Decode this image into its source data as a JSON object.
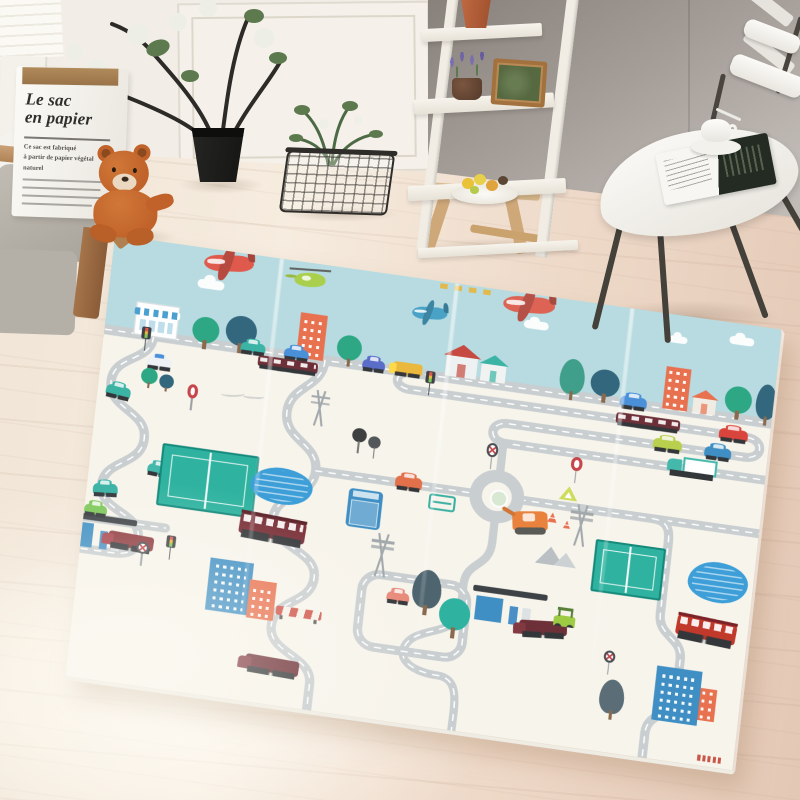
{
  "poster": {
    "title_line1": "Le sac",
    "title_line2": "en papier",
    "body_lines": [
      "Ce sac est fabriqué",
      "à partir de papier végétal",
      "naturel"
    ]
  },
  "colors": {
    "wall_left": "#f2eee7",
    "wall_right": "#9b948e",
    "sofa": "#c2bdb4",
    "wood": "#a5744a",
    "teddy": "#c0622a",
    "plant_pot": "#141412",
    "basket": "#2f2d2a",
    "shelf": "#f1ede4",
    "chair": "#f6f4ef",
    "floor": "#f0e2d2"
  },
  "mat": {
    "sky_color": "#b7dbe0",
    "ground_color": "#f7f4ec",
    "road_color": "#c9ced0",
    "road_dash_color": "#ffffff",
    "crease_positions": [
      160,
      330,
      500
    ],
    "roads": [
      {
        "d": "M -12 95 H 662",
        "w": 10
      },
      {
        "d": "M 300 95 C 282 95 282 112 300 112 H 628 C 646 112 646 132 628 132 H 398 C 379 132 379 152 398 152 H 662",
        "w": 9
      },
      {
        "d": "M 48 95 C 48 122 12 118 12 146 C 12 174 50 170 50 198 C 50 226 14 224 14 250 C 14 276 55 272 55 298 C 55 314 42 316 30 316 H -12",
        "w": 9
      },
      {
        "d": "M 215 95 C 215 124 184 124 184 152 C 184 180 218 178 218 206 C 218 234 182 232 182 260 C 182 288 228 284 228 312 C 228 340 192 338 192 366 C 192 394 235 390 235 418 V 450",
        "w": 9
      },
      {
        "d": "M 218 206 H 374",
        "w": 9
      },
      {
        "d": "M 395 152 V 183",
        "w": 8,
        "nd": true
      },
      {
        "d": "M 416 206 H 662",
        "w": 9
      },
      {
        "d": "M 395 227 V 252 C 395 278 372 274 372 298 V 322",
        "w": 8,
        "nd": true
      },
      {
        "d": "M 372 322 C 372 352 330 345 322 368 C 316 386 340 392 356 392 C 380 392 376 418 376 450",
        "w": 8
      },
      {
        "d": "M 546 206 C 564 206 564 218 564 232 V 300 C 564 322 588 320 588 342 V 378 C 588 400 562 398 562 420 V 450",
        "w": 9
      },
      {
        "d": "M 292 300 H 360 A 17 17 0 0 1 377 317 V 356 A 17 17 0 0 1 360 373 H 292 A 17 17 0 0 1 275 356 V 317 A 17 17 0 0 1 292 300 Z",
        "w": 9
      },
      {
        "d": "M -12 284 H 80",
        "w": 9
      },
      {
        "d": "M 415 206 A 20.5 20.5 0 1 1 374 206 A 20.5 20.5 0 1 1 415 206",
        "w": 12,
        "nd": true
      }
    ],
    "items": [
      {
        "t": "plane",
        "x": 88,
        "y": 4,
        "w": 48,
        "h": 16,
        "c": "#df5a4c",
        "r": -6
      },
      {
        "t": "plane",
        "x": 378,
        "y": 3,
        "w": 50,
        "h": 16,
        "c": "#dd6355",
        "r": -4
      },
      {
        "t": "heli",
        "x": 176,
        "y": 10,
        "w": 30,
        "h": 14,
        "c": "#a9cf4d",
        "r": -4
      },
      {
        "t": "plane",
        "x": 292,
        "y": 27,
        "w": 34,
        "h": 12,
        "c": "#4aa3c7",
        "r": -5
      },
      {
        "t": "cloud",
        "x": 84,
        "y": 31,
        "w": 26,
        "h": 9,
        "c": "#ffffff"
      },
      {
        "t": "cloud",
        "x": 400,
        "y": 26,
        "w": 24,
        "h": 8,
        "c": "#ffffff"
      },
      {
        "t": "cloud",
        "x": 598,
        "y": 13,
        "w": 24,
        "h": 8,
        "c": "#ffffff"
      },
      {
        "t": "cloud",
        "x": 540,
        "y": 21,
        "w": 18,
        "h": 7,
        "c": "#ffffff"
      },
      {
        "t": "dashes",
        "x": 316,
        "y": 2,
        "w": 54,
        "h": 5,
        "c": "#e7b53c"
      },
      {
        "t": "shop",
        "x": 28,
        "y": 62,
        "w": 42,
        "h": 33,
        "c": "#ffffff",
        "c2": "#4aa0d0"
      },
      {
        "t": "tree",
        "x": 84,
        "y": 68,
        "w": 26,
        "h": 26,
        "c": "#2ea884"
      },
      {
        "t": "tree",
        "x": 116,
        "y": 62,
        "w": 30,
        "h": 30,
        "c": "#33677e"
      },
      {
        "t": "tlight",
        "x": 36,
        "y": 86,
        "w": 9,
        "h": 24
      },
      {
        "t": "bldg",
        "x": 186,
        "y": 50,
        "w": 26,
        "h": 45,
        "c": "#e8714f"
      },
      {
        "t": "car",
        "x": 132,
        "y": 87,
        "w": 24,
        "h": 10,
        "c": "#3bb3a5"
      },
      {
        "t": "car",
        "x": 174,
        "y": 87,
        "w": 24,
        "h": 10,
        "c": "#4a90d9"
      },
      {
        "t": "tree",
        "x": 224,
        "y": 66,
        "w": 24,
        "h": 25,
        "c": "#2ea884"
      },
      {
        "t": "train",
        "x": 150,
        "y": 98,
        "w": 58,
        "h": 11,
        "c": "#6e3038"
      },
      {
        "t": "car",
        "x": 250,
        "y": 87,
        "w": 22,
        "h": 10,
        "c": "#5a6ec9"
      },
      {
        "t": "truck",
        "x": 280,
        "y": 85,
        "w": 28,
        "h": 12,
        "c": "#e9b83c"
      },
      {
        "t": "tlight",
        "x": 312,
        "y": 90,
        "w": 9,
        "h": 24
      },
      {
        "t": "house",
        "x": 330,
        "y": 70,
        "w": 30,
        "h": 22,
        "c": "#eef1f1",
        "c2": "#c64a42"
      },
      {
        "t": "house",
        "x": 364,
        "y": 74,
        "w": 24,
        "h": 18,
        "c": "#f0f3f2",
        "c2": "#3bb3a5"
      },
      {
        "t": "poplar",
        "x": 440,
        "y": 58,
        "w": 24,
        "h": 35,
        "c": "#3f9f8a"
      },
      {
        "t": "tree",
        "x": 470,
        "y": 64,
        "w": 28,
        "h": 27,
        "c": "#33677e"
      },
      {
        "t": "car",
        "x": 500,
        "y": 87,
        "w": 26,
        "h": 11,
        "c": "#4a90d9"
      },
      {
        "t": "bldg",
        "x": 541,
        "y": 52,
        "w": 24,
        "h": 42,
        "c": "#e8714f"
      },
      {
        "t": "house",
        "x": 570,
        "y": 78,
        "w": 22,
        "h": 16,
        "c": "#f0ece4",
        "c2": "#e8714f"
      },
      {
        "t": "tree",
        "x": 600,
        "y": 62,
        "w": 26,
        "h": 27,
        "c": "#2ea884"
      },
      {
        "t": "poplar",
        "x": 630,
        "y": 56,
        "w": 20,
        "h": 35,
        "c": "#33677e"
      },
      {
        "t": "train",
        "x": 498,
        "y": 104,
        "w": 62,
        "h": 11,
        "c": "#6e3038"
      },
      {
        "t": "car",
        "x": 598,
        "y": 105,
        "w": 28,
        "h": 11,
        "c": "#d9453c"
      },
      {
        "t": "car",
        "x": 536,
        "y": 124,
        "w": 28,
        "h": 11,
        "c": "#b9cf4e"
      },
      {
        "t": "car",
        "x": 586,
        "y": 125,
        "w": 26,
        "h": 11,
        "c": "#3f8fc4"
      },
      {
        "t": "dtruck",
        "x": 552,
        "y": 140,
        "w": 48,
        "h": 16,
        "c": "#45b8ac"
      },
      {
        "t": "script",
        "x": 118,
        "y": 134,
        "w": 42,
        "h": 12
      },
      {
        "t": "car",
        "x": 44,
        "y": 114,
        "w": 24,
        "h": 11,
        "c": "#eef2f4",
        "c2": "#4a90d9"
      },
      {
        "t": "car",
        "x": 8,
        "y": 148,
        "w": 24,
        "h": 11,
        "c": "#3bb3a5",
        "r": 6
      },
      {
        "t": "car",
        "x": 6,
        "y": 246,
        "w": 24,
        "h": 11,
        "c": "#3bb3a5",
        "r": -5
      },
      {
        "t": "car",
        "x": 56,
        "y": 220,
        "w": 22,
        "h": 10,
        "c": "#45b8ac",
        "r": 4
      },
      {
        "t": "tree",
        "x": 40,
        "y": 126,
        "w": 16,
        "h": 16,
        "c": "#2ea884"
      },
      {
        "t": "tree",
        "x": 58,
        "y": 130,
        "w": 14,
        "h": 14,
        "c": "#33677e"
      },
      {
        "t": "sign",
        "x": 84,
        "y": 136,
        "w": 14,
        "h": 26
      },
      {
        "t": "lolli",
        "x": 248,
        "y": 156,
        "w": 14,
        "h": 14,
        "c": "#3d3f41"
      },
      {
        "t": "lolli",
        "x": 264,
        "y": 162,
        "w": 12,
        "h": 12,
        "c": "#54575a"
      },
      {
        "t": "pylon",
        "x": 204,
        "y": 124,
        "w": 20,
        "h": 36
      },
      {
        "t": "court",
        "x": 68,
        "y": 198,
        "w": 94,
        "h": 62,
        "c": "#2fb3a0",
        "c2": "#15897b"
      },
      {
        "t": "pond",
        "x": 156,
        "y": 206,
        "w": 60,
        "h": 36,
        "c": "#3e9fd8"
      },
      {
        "t": "signx",
        "x": 376,
        "y": 152,
        "w": 15,
        "h": 26
      },
      {
        "t": "sign",
        "x": 458,
        "y": 154,
        "w": 15,
        "h": 26
      },
      {
        "t": "tri",
        "x": 452,
        "y": 184,
        "w": 18,
        "h": 14,
        "c": "#cddc5a"
      },
      {
        "t": "cone",
        "x": 442,
        "y": 212,
        "w": 12,
        "h": 10,
        "c": "#e8714f"
      },
      {
        "t": "cone",
        "x": 458,
        "y": 218,
        "w": 9,
        "h": 8,
        "c": "#e8714f"
      },
      {
        "t": "pylon",
        "x": 464,
        "y": 200,
        "w": 24,
        "h": 42
      },
      {
        "t": "rnd",
        "x": 386,
        "y": 197,
        "w": 18,
        "h": 18,
        "c": "#d9e8d2"
      },
      {
        "t": "car",
        "x": 294,
        "y": 197,
        "w": 26,
        "h": 12,
        "c": "#e2704a"
      },
      {
        "t": "bench",
        "x": 328,
        "y": 210,
        "w": 26,
        "h": 16,
        "c": "#3bb0a2"
      },
      {
        "t": "digger",
        "x": 410,
        "y": 214,
        "w": 34,
        "h": 20,
        "c": "#e8823c",
        "r": -8
      },
      {
        "t": "truckv",
        "x": 251,
        "y": 216,
        "w": 33,
        "h": 38,
        "c": "#3f8fc4"
      },
      {
        "t": "bus",
        "x": 150,
        "y": 254,
        "w": 64,
        "h": 23,
        "c": "#7a3038",
        "c2": "#5a2228",
        "r": 3
      },
      {
        "t": "pylon",
        "x": 276,
        "y": 256,
        "w": 26,
        "h": 44
      },
      {
        "t": "mtn",
        "x": 436,
        "y": 246,
        "w": 40,
        "h": 18
      },
      {
        "t": "court",
        "x": 492,
        "y": 232,
        "w": 68,
        "h": 52,
        "c": "#2fb3a0",
        "c2": "#15897b"
      },
      {
        "t": "pond",
        "x": 584,
        "y": 238,
        "w": 58,
        "h": 40,
        "c": "#3e9fd8"
      },
      {
        "t": "bus",
        "x": 578,
        "y": 294,
        "w": 58,
        "h": 22,
        "c": "#c0392b",
        "c2": "#7a2328",
        "r": 4
      },
      {
        "t": "gas",
        "x": -18,
        "y": 278,
        "w": 70,
        "h": 38,
        "c2": "#3f8fc4"
      },
      {
        "t": "truck",
        "x": 26,
        "y": 292,
        "w": 44,
        "h": 14,
        "c": "#8e3a40",
        "r": 2
      },
      {
        "t": "car",
        "x": 0,
        "y": 268,
        "w": 22,
        "h": 10,
        "c": "#7dc85a"
      },
      {
        "t": "signx",
        "x": 52,
        "y": 298,
        "w": 16,
        "h": 24
      },
      {
        "t": "tlight",
        "x": 82,
        "y": 288,
        "w": 9,
        "h": 24
      },
      {
        "t": "bldg",
        "x": 126,
        "y": 304,
        "w": 42,
        "h": 52,
        "c": "#3f8fc4"
      },
      {
        "t": "bldg",
        "x": 166,
        "y": 320,
        "w": 26,
        "h": 38,
        "c": "#e8714f"
      },
      {
        "t": "barrier",
        "x": 194,
        "y": 342,
        "w": 44,
        "h": 9
      },
      {
        "t": "truck",
        "x": 170,
        "y": 394,
        "w": 52,
        "h": 15,
        "c": "#6e3038",
        "r": 2
      },
      {
        "t": "poplar",
        "x": 322,
        "y": 286,
        "w": 28,
        "h": 38,
        "c": "#4e646e"
      },
      {
        "t": "tree",
        "x": 350,
        "y": 310,
        "w": 30,
        "h": 32,
        "c": "#2fb3a0"
      },
      {
        "t": "car",
        "x": 298,
        "y": 312,
        "w": 22,
        "h": 10,
        "c": "#e88a7a"
      },
      {
        "t": "gas",
        "x": 380,
        "y": 294,
        "w": 72,
        "h": 40,
        "c2": "#3f8fc4"
      },
      {
        "t": "truck",
        "x": 428,
        "y": 320,
        "w": 46,
        "h": 14,
        "c": "#6e3038",
        "r": -5
      },
      {
        "t": "cart",
        "x": 460,
        "y": 304,
        "w": 26,
        "h": 20,
        "c": "#9ecb44"
      },
      {
        "t": "bldg",
        "x": 564,
        "y": 348,
        "w": 44,
        "h": 54,
        "c": "#3f8fc4"
      },
      {
        "t": "bldg",
        "x": 608,
        "y": 364,
        "w": 16,
        "h": 32,
        "c": "#e8714f"
      },
      {
        "t": "signx",
        "x": 510,
        "y": 340,
        "w": 15,
        "h": 24
      },
      {
        "t": "poplar",
        "x": 512,
        "y": 368,
        "w": 24,
        "h": 34,
        "c": "#5b6e78"
      },
      {
        "t": "brand",
        "x": 612,
        "y": 430,
        "w": 24,
        "h": 6,
        "c": "#c0392b"
      }
    ]
  }
}
